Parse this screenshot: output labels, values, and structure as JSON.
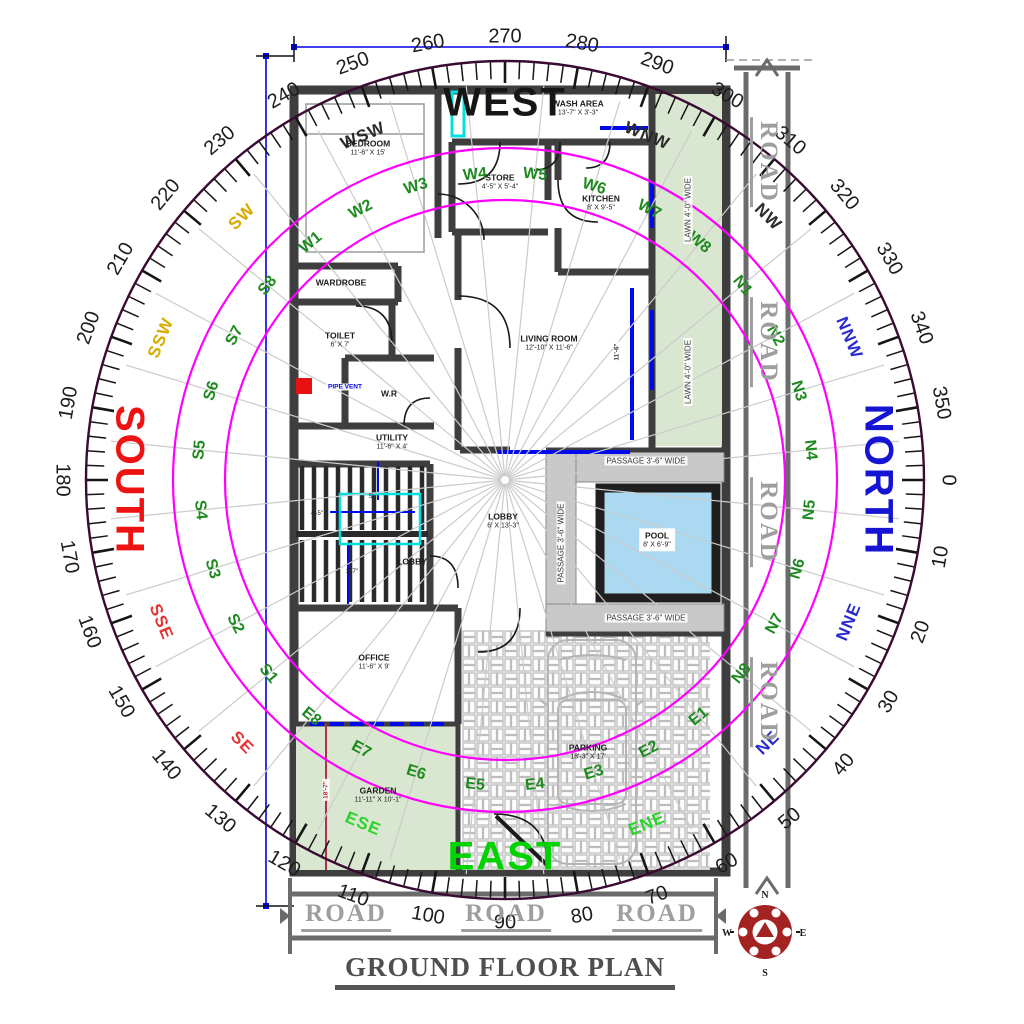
{
  "title": {
    "text": "GROUND FLOOR PLAN"
  },
  "compass": {
    "degree_labels": [
      "0",
      "10",
      "20",
      "30",
      "40",
      "50",
      "60",
      "70",
      "80",
      "90",
      "100",
      "110",
      "120",
      "130",
      "140",
      "150",
      "160",
      "170",
      "180",
      "190",
      "200",
      "210",
      "220",
      "230",
      "240",
      "250",
      "260",
      "270",
      "280",
      "290",
      "300",
      "310",
      "320",
      "330",
      "340",
      "350"
    ],
    "cardinals": [
      {
        "label": "NORTH",
        "deg": 0,
        "r": 373,
        "color": "#1414d2"
      },
      {
        "label": "EAST",
        "deg": 90,
        "r": 377,
        "color": "#00d300"
      },
      {
        "label": "SOUTH",
        "deg": 180,
        "r": 376,
        "color": "#ee1212"
      },
      {
        "label": "WEST",
        "deg": 270,
        "r": 377,
        "color": "#161616"
      }
    ],
    "subdirections": [
      {
        "label": "NNE",
        "deg": 22.5,
        "color": "#2a2ad0"
      },
      {
        "label": "NE",
        "deg": 45,
        "color": "#2a2ad0"
      },
      {
        "label": "ENE",
        "deg": 67.5,
        "color": "#2bd42b"
      },
      {
        "label": "ESE",
        "deg": 112.5,
        "color": "#2bd42b"
      },
      {
        "label": "SE",
        "deg": 135,
        "color": "#e63333"
      },
      {
        "label": "SSE",
        "deg": 157.5,
        "color": "#e63333"
      },
      {
        "label": "SSW",
        "deg": 202.5,
        "color": "#d8ab00"
      },
      {
        "label": "SW",
        "deg": 225,
        "color": "#d8ab00"
      },
      {
        "label": "WSW",
        "deg": 247.5,
        "color": "#2b2b2b"
      },
      {
        "label": "WNW",
        "deg": 292.5,
        "color": "#2b2b2b"
      },
      {
        "label": "NW",
        "deg": 315,
        "color": "#2b2b2b"
      },
      {
        "label": "NNW",
        "deg": 337.5,
        "color": "#2a2ad0"
      }
    ],
    "zones": [
      {
        "label": "N1",
        "deg": 320.625
      },
      {
        "label": "N2",
        "deg": 331.875
      },
      {
        "label": "N3",
        "deg": 343.125
      },
      {
        "label": "N4",
        "deg": 354.375
      },
      {
        "label": "N5",
        "deg": 5.625
      },
      {
        "label": "N6",
        "deg": 16.875
      },
      {
        "label": "N7",
        "deg": 28.125
      },
      {
        "label": "N8",
        "deg": 39.375
      },
      {
        "label": "E1",
        "deg": 50.625
      },
      {
        "label": "E2",
        "deg": 61.875
      },
      {
        "label": "E3",
        "deg": 73.125
      },
      {
        "label": "E4",
        "deg": 84.375
      },
      {
        "label": "E5",
        "deg": 95.625
      },
      {
        "label": "E6",
        "deg": 106.875
      },
      {
        "label": "E7",
        "deg": 118.125
      },
      {
        "label": "E8",
        "deg": 129.375
      },
      {
        "label": "S1",
        "deg": 140.625
      },
      {
        "label": "S2",
        "deg": 151.875
      },
      {
        "label": "S3",
        "deg": 163.125
      },
      {
        "label": "S4",
        "deg": 174.375
      },
      {
        "label": "S5",
        "deg": 185.625
      },
      {
        "label": "S6",
        "deg": 196.875
      },
      {
        "label": "S7",
        "deg": 208.125
      },
      {
        "label": "S8",
        "deg": 219.375
      },
      {
        "label": "W1",
        "deg": 230.625
      },
      {
        "label": "W2",
        "deg": 241.875
      },
      {
        "label": "W3",
        "deg": 253.125
      },
      {
        "label": "W4",
        "deg": 264.375
      },
      {
        "label": "W5",
        "deg": 275.625
      },
      {
        "label": "W6",
        "deg": 286.875
      },
      {
        "label": "W7",
        "deg": 298.125
      },
      {
        "label": "W8",
        "deg": 309.375
      }
    ]
  },
  "plan": {
    "rooms": [
      {
        "name": "bedroom",
        "lines": [
          "BEDROOM",
          "11'-6\" X 15'"
        ],
        "x": 368,
        "y": 148
      },
      {
        "name": "wash-area",
        "lines": [
          "WASH AREA",
          "13'-7\" X 3'-3\""
        ],
        "x": 578,
        "y": 108
      },
      {
        "name": "store",
        "lines": [
          "STORE",
          "4'-5\" X 5'-4\""
        ],
        "x": 500,
        "y": 182
      },
      {
        "name": "kitchen",
        "lines": [
          "KITCHEN",
          "8' X 9'-5\""
        ],
        "x": 601,
        "y": 203
      },
      {
        "name": "wardrobe",
        "lines": [
          "WARDROBE"
        ],
        "x": 341,
        "y": 283
      },
      {
        "name": "toilet",
        "lines": [
          "TOILET",
          "6' X 7'"
        ],
        "x": 340,
        "y": 340
      },
      {
        "name": "wr",
        "lines": [
          "W.R"
        ],
        "x": 389,
        "y": 394
      },
      {
        "name": "utility",
        "lines": [
          "UTILITY",
          "11'-6\" X 4'"
        ],
        "x": 392,
        "y": 442
      },
      {
        "name": "living-room",
        "lines": [
          "LIVING ROOM",
          "12'-10\" X 11'-6\""
        ],
        "x": 549,
        "y": 343
      },
      {
        "name": "lobby",
        "lines": [
          "LOBBY",
          "6' X 13'-3\""
        ],
        "x": 503,
        "y": 521
      },
      {
        "name": "lobby-2",
        "lines": [
          "LOBBY"
        ],
        "x": 412,
        "y": 562
      },
      {
        "name": "office",
        "lines": [
          "OFFICE",
          "11'-6\" X 9'"
        ],
        "x": 374,
        "y": 662
      },
      {
        "name": "garden",
        "lines": [
          "GARDEN",
          "11'-11\" X 10'-1\""
        ],
        "x": 378,
        "y": 795
      },
      {
        "name": "parking",
        "lines": [
          "PARKING",
          "18'-3\" X 17'"
        ],
        "x": 588,
        "y": 752
      },
      {
        "name": "pool",
        "lines": [
          "POOL",
          "8' X 6'-9\""
        ],
        "x": 657,
        "y": 540,
        "chip": true
      }
    ],
    "notes": [
      {
        "name": "passage-label-top",
        "text": "PASSAGE 3'-6\" WIDE",
        "x": 646,
        "y": 461
      },
      {
        "name": "passage-label-vertical",
        "text": "PASSAGE 3'-6\" WIDE",
        "x": 561,
        "y": 543,
        "rot": -90
      },
      {
        "name": "passage-label-bottom",
        "text": "PASSAGE 3'-6\" WIDE",
        "x": 646,
        "y": 618
      },
      {
        "name": "lawn-label-1",
        "text": "LAWN 4'-0\" WIDE",
        "x": 688,
        "y": 210,
        "rot": -90
      },
      {
        "name": "lawn-label-2",
        "text": "LAWN 4'-0\" WIDE",
        "x": 688,
        "y": 372,
        "rot": -90
      },
      {
        "name": "pipe-vent-label",
        "text": "PIPE VENT",
        "x": 345,
        "y": 387,
        "color": "#0000ee",
        "cls": "tiny"
      },
      {
        "name": "garden-dim",
        "text": "18'-7\"",
        "x": 326,
        "y": 790,
        "rot": -90,
        "color": "#cc2233",
        "cls": "tiny"
      },
      {
        "name": "living-dim",
        "text": "11'-6\"",
        "x": 617,
        "y": 352,
        "rot": -90,
        "cls": "tiny"
      },
      {
        "name": "stair-dim-1",
        "text": "4'-5\"",
        "x": 317,
        "y": 514,
        "cls": "micro"
      },
      {
        "name": "stair-dim-2",
        "text": "5'",
        "x": 371,
        "y": 497,
        "cls": "micro"
      },
      {
        "name": "stair-dim-3",
        "text": "3'-7\"",
        "x": 352,
        "y": 572,
        "cls": "micro"
      }
    ],
    "roads": [
      {
        "text": "ROAD",
        "x": 766,
        "y": 162,
        "rot": 90
      },
      {
        "text": "ROAD",
        "x": 766,
        "y": 342,
        "rot": 90
      },
      {
        "text": "ROAD",
        "x": 766,
        "y": 522,
        "rot": 90
      },
      {
        "text": "ROAD",
        "x": 766,
        "y": 702,
        "rot": 90
      },
      {
        "text": "ROAD",
        "x": 346,
        "y": 916
      },
      {
        "text": "ROAD",
        "x": 506,
        "y": 916
      },
      {
        "text": "ROAD",
        "x": 657,
        "y": 916
      }
    ]
  }
}
